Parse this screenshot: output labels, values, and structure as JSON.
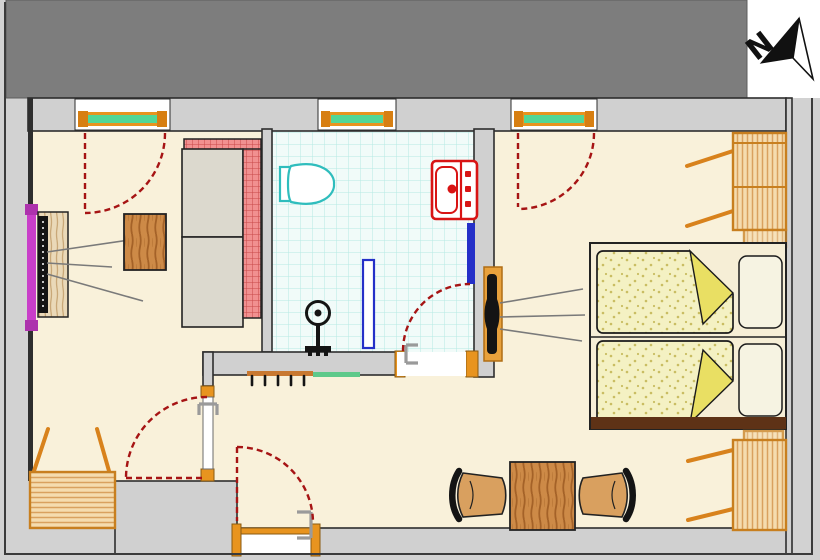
{
  "compass": {
    "label": "N",
    "icon": "north-arrow"
  },
  "palette": {
    "background": "#d2d2d2",
    "building_mass": "#7d7d7d",
    "wall_fill": "#d0d0d0",
    "wall_line": "#2e2e2e",
    "floor": "#f9f1da",
    "bathroom_tile": "#f1fbf9",
    "tile_grid": "#b5e9e4",
    "window_frame": "#e8941f",
    "window_glass": "#52d796",
    "door_swing": "#a61414",
    "door_frame": "#e8941f",
    "sofa_back": "#f19090",
    "sofa_seat": "#dcd9ce",
    "wardrobe": "#f5dcae",
    "wardrobe_frame": "#c87f1f",
    "duvet": "#f4f1c3",
    "duvet_fold": "#e9df63",
    "pillow": "#f6f3e2",
    "bed_footboard": "#5e3216",
    "tv": "#141414",
    "radiator": "#c93fc9",
    "toilet": "#2fbdbd",
    "sink": "#d81414",
    "shower_door": "#2430c8",
    "shelf": "#5ec98a",
    "coat_rack": "#c87830"
  },
  "rooms": [
    {
      "name": "living-room"
    },
    {
      "name": "bathroom"
    },
    {
      "name": "bedroom"
    },
    {
      "name": "hallway"
    }
  ],
  "elements": [
    {
      "name": "north-arrow"
    },
    {
      "name": "window",
      "count": 3
    },
    {
      "name": "balcony-door-swing",
      "count": 2
    },
    {
      "name": "entry-door"
    },
    {
      "name": "interior-door",
      "count": 2
    },
    {
      "name": "sofa-bed"
    },
    {
      "name": "coffee-table"
    },
    {
      "name": "tv-cabinet"
    },
    {
      "name": "wall-radiator"
    },
    {
      "name": "toilet"
    },
    {
      "name": "washbasin"
    },
    {
      "name": "shower-screen"
    },
    {
      "name": "pedestal-fixture"
    },
    {
      "name": "coat-rack"
    },
    {
      "name": "wall-shelf"
    },
    {
      "name": "double-bed"
    },
    {
      "name": "wardrobe",
      "count": 3
    },
    {
      "name": "wall-tv",
      "count": 2
    },
    {
      "name": "dining-table"
    },
    {
      "name": "chair",
      "count": 2
    }
  ]
}
